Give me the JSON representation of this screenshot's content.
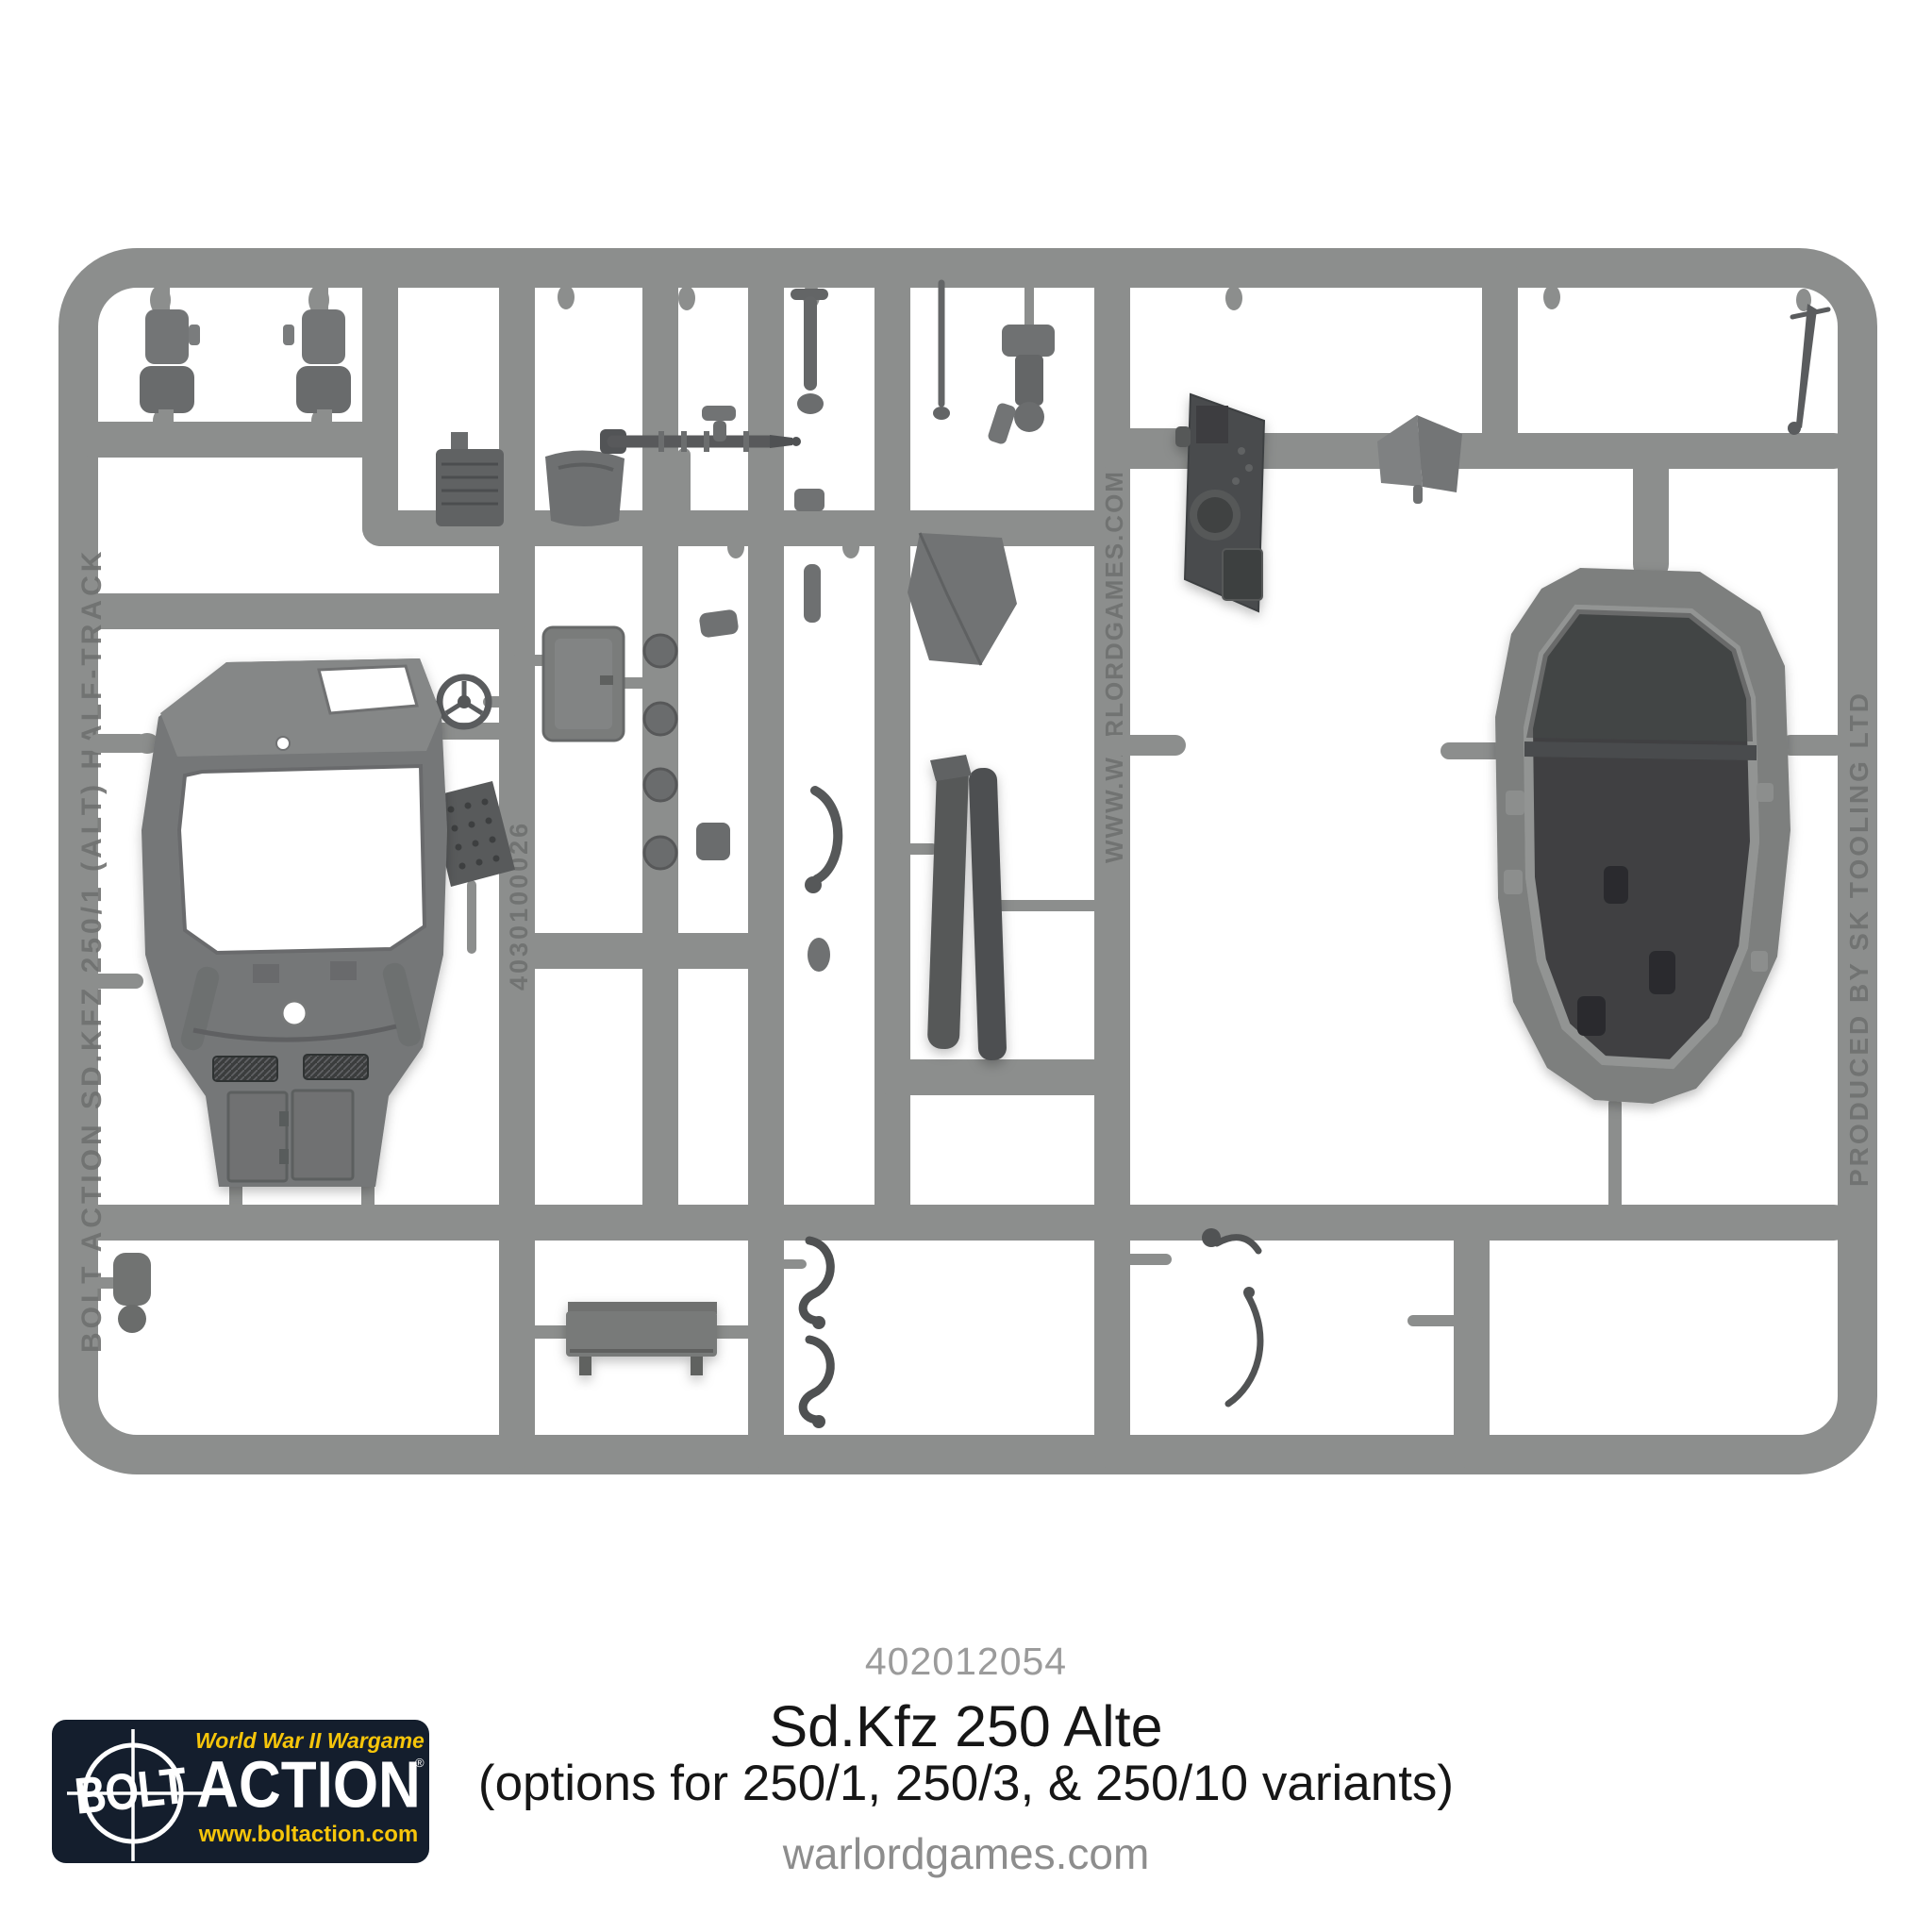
{
  "page": {
    "background": "#ffffff"
  },
  "product": {
    "sku": "402012054",
    "title": "Sd.Kfz 250 Alte",
    "subtitle": "(options for 250/1, 250/3, & 250/10 variants)",
    "website": "warlordgames.com"
  },
  "logo": {
    "tagline": "World War II Wargame",
    "brand_word_1": "BOLT",
    "brand_word_2": "ACTION",
    "registered_mark": "®",
    "url": "www.boltaction.com",
    "colors": {
      "background": "#141e2d",
      "yellow": "#f6c50a",
      "white": "#ffffff"
    }
  },
  "sprue": {
    "plastic_color": "#8c8e8d",
    "dark_part_color": "#4a4c4e",
    "embossed_texts": [
      {
        "label": "BOLT ACTION SD.KFZ 250/1 (ALT) HALF-TRACK",
        "location": "left-rail"
      },
      {
        "label": "4030100026",
        "location": "inner-left-rail"
      },
      {
        "label": "WWW.WARLORDGAMES.COM",
        "location": "inner-right-rail"
      },
      {
        "label": "PRODUCED BY SK TOOLING LTD",
        "location": "right-rail"
      }
    ]
  },
  "text_colors": {
    "sku": "#9b9b9b",
    "title": "#161616",
    "website": "#8d8d8d"
  }
}
